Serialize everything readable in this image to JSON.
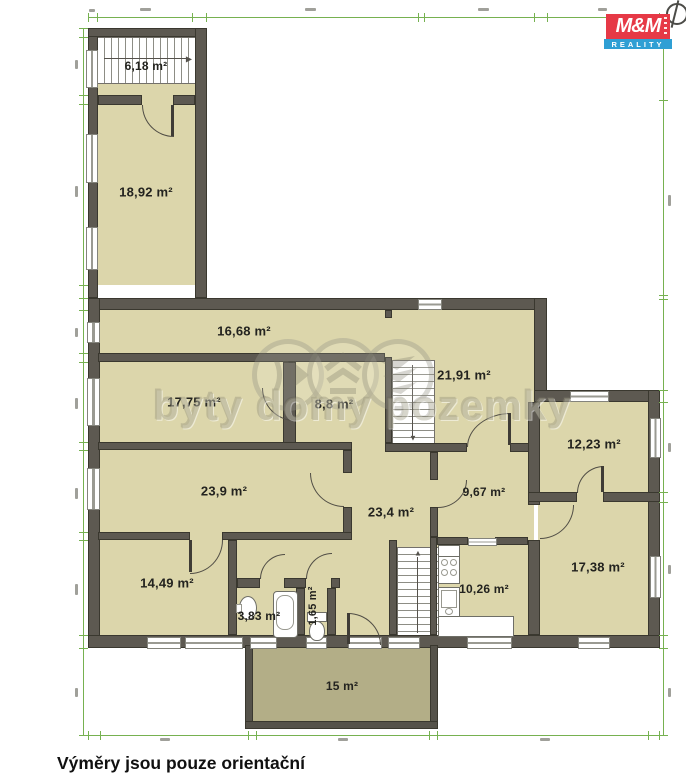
{
  "floorplan": {
    "rooms": [
      {
        "id": "stairwell-top",
        "label": "6,18 m²"
      },
      {
        "id": "room-1892",
        "label": "18,92 m²"
      },
      {
        "id": "room-1668",
        "label": "16,68 m²"
      },
      {
        "id": "room-1775",
        "label": "17,75 m²"
      },
      {
        "id": "room-88",
        "label": "8,8 m²"
      },
      {
        "id": "room-2191",
        "label": "21,91 m²"
      },
      {
        "id": "room-1223",
        "label": "12,23 m²"
      },
      {
        "id": "room-239",
        "label": "23,9 m²"
      },
      {
        "id": "hall-234",
        "label": "23,4 m²"
      },
      {
        "id": "room-967",
        "label": "9,67 m²"
      },
      {
        "id": "room-1738",
        "label": "17,38 m²"
      },
      {
        "id": "room-1449",
        "label": "14,49 m²"
      },
      {
        "id": "bathroom-383",
        "label": "3,83 m²"
      },
      {
        "id": "wc-165",
        "label": "1,65 m²"
      },
      {
        "id": "kitchen-1026",
        "label": "10,26 m²"
      },
      {
        "id": "terrace-15",
        "label": "15 m²"
      }
    ]
  },
  "watermark": {
    "text": "byty domy pozemky"
  },
  "branding": {
    "logo_top": "M&M",
    "logo_bottom": "REALITY"
  },
  "caption": "Výměry jsou pouze orientační",
  "colors": {
    "room_fill": "#dcd6ab",
    "terrace_fill": "#b3ae87",
    "wall": "#5d5951",
    "dimension_green": "#76b150",
    "logo_red": "#e63946",
    "logo_blue": "#2f9fd4"
  }
}
